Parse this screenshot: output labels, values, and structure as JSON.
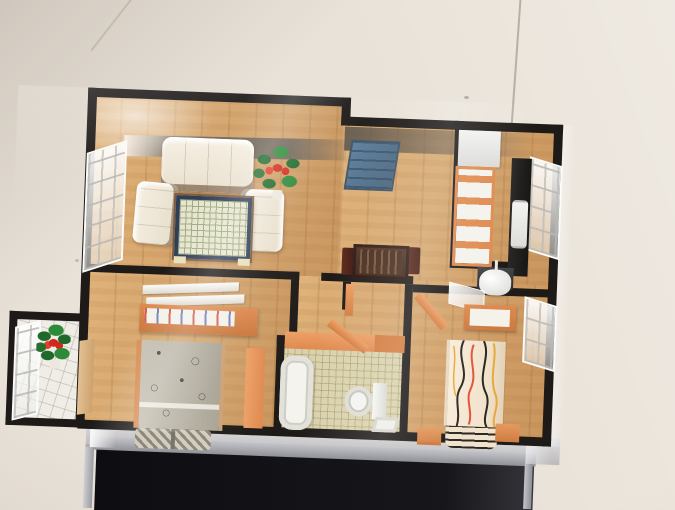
{
  "scene": {
    "type": "photograph",
    "subject": "miniature apartment scale model (top-down dollhouse floor plan) under a clear acrylic case",
    "environment": "beige tiled showroom floor",
    "stand": "dark display table with light grey top edge and clear glass front"
  },
  "colors": {
    "bg-floor": "#e9e2d8",
    "bg-shade": "#d3cbc0",
    "wall": "#1d1a18",
    "wood-light": "#dfb279",
    "wood-dark": "#c9965e",
    "orange": "#df8a4f",
    "cream": "#f6f0e3",
    "band-shadow": "#7c7264",
    "table-border": "#2e3e57",
    "table-top": "#e9e5cc",
    "table-grid": "#9aab88",
    "panel-blue": "#5e7f9d",
    "counter": "#191715",
    "tile-bath": "#dad2ac",
    "blanket-gray": "#b5afa1",
    "blanket-cream": "#f1e2cb",
    "leaf": "#1e692b",
    "flower": "#d3281c"
  },
  "model": {
    "walls": "black partition walls with stepped outline",
    "rooms": [
      {
        "name": "living-room",
        "items": [
          "three-seat-sofa",
          "armchair-left",
          "armchair-right",
          "checkered-coffee-table",
          "potted-plant-red-flowers",
          "window-wall-left"
        ]
      },
      {
        "name": "dining-area",
        "items": [
          "dark-wood-dining-table",
          "dining-chairs",
          "slate-blue-panel"
        ]
      },
      {
        "name": "kitchen",
        "items": [
          "white-upper-cabinet",
          "orange-cabinet-row",
          "black-counter",
          "white-sink-unit",
          "window-right"
        ]
      },
      {
        "name": "bedroom-left",
        "items": [
          "white-wall-shelves",
          "orange-desk",
          "book-row",
          "bed-gray-floral-blanket",
          "checkered-pillows",
          "orange-bench",
          "wood-door"
        ]
      },
      {
        "name": "bathroom",
        "items": [
          "bathtub",
          "toilet",
          "small-sink",
          "beige-tile-floor",
          "orange-walls",
          "orange-door"
        ]
      },
      {
        "name": "bedroom-right",
        "items": [
          "white-tv-on-dark-stand",
          "mirror",
          "orange-dresser",
          "bed-striped-cream-blanket",
          "orange-nightstands",
          "window-right-wall"
        ]
      },
      {
        "name": "balcony",
        "items": [
          "white-tile-floor",
          "potted-plant-red-flowers",
          "window-frame"
        ]
      }
    ]
  }
}
